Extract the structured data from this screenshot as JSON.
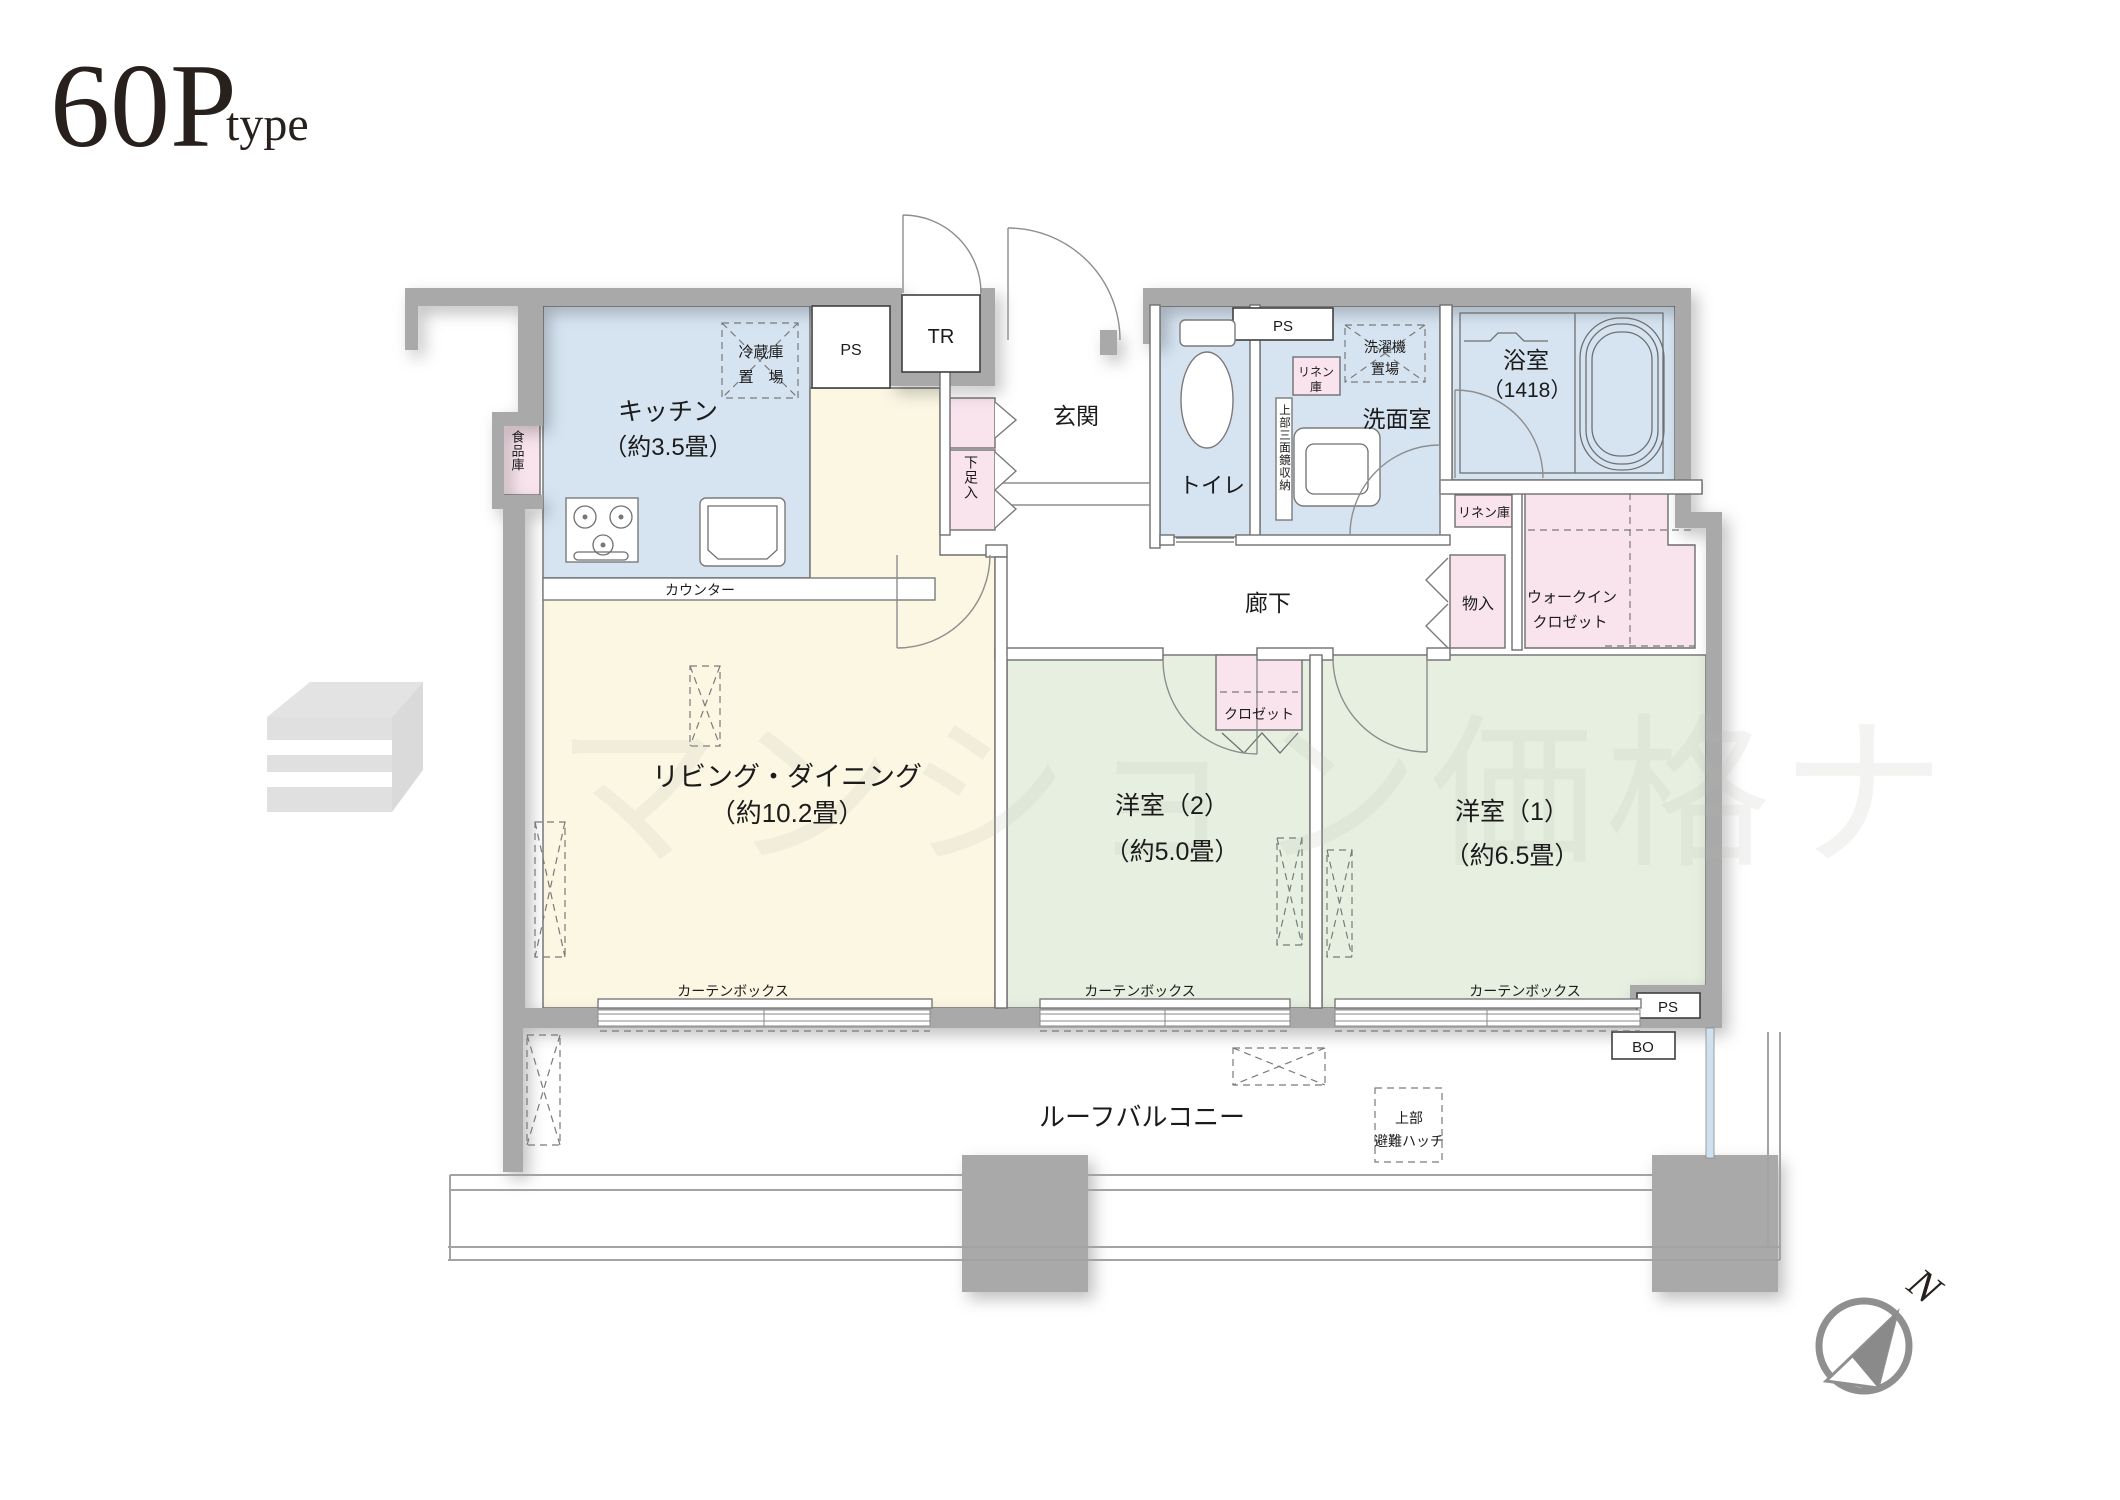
{
  "title": {
    "main": "60P",
    "sub": "type"
  },
  "watermark": {
    "text": "マンション価格ナ"
  },
  "compass": {
    "north": "N"
  },
  "colors": {
    "wall": "#a9a9a9",
    "water": "#d6e4f2",
    "living": "#fbf7e3",
    "bedroom": "#e7efe1",
    "storage_pink": "#f9e4ed",
    "glass": "#cfe0ef"
  },
  "rooms": {
    "kitchen": {
      "name": "キッチン",
      "size": "（約3.5畳）"
    },
    "living": {
      "name": "リビング・ダイニング",
      "size": "（約10.2畳）"
    },
    "bedroom2": {
      "name": "洋室（2）",
      "size": "（約5.0畳）"
    },
    "bedroom1": {
      "name": "洋室（1）",
      "size": "（約6.5畳）"
    },
    "bath": {
      "name": "浴室",
      "size": "（1418）"
    },
    "washroom": {
      "name": "洗面室"
    },
    "toilet": {
      "name": "トイレ"
    },
    "entrance": {
      "name": "玄関"
    },
    "hallway": {
      "name": "廊下"
    },
    "roof_balcony": {
      "name": "ルーフバルコニー"
    }
  },
  "storage": {
    "refrigerator": {
      "line1": "冷蔵庫",
      "line2": "置　場"
    },
    "pantry": "食品庫",
    "shoe_box": "下足入",
    "washer": {
      "line1": "洗濯機",
      "line2": "置場"
    },
    "linen_washroom": {
      "line1": "リネン",
      "line2": "庫"
    },
    "linen_hall": "リネン庫",
    "mirror_cabinet": "上部三面鏡収納",
    "closet_hall": "物入",
    "walk_in_closet": {
      "line1": "ウォークイン",
      "line2": "クロゼット"
    },
    "closet_bedroom2": "クロゼット",
    "hatch": {
      "line1": "上部",
      "line2": "避難ハッチ"
    }
  },
  "features": {
    "counter": "カウンター",
    "curtain_box": "カーテンボックス"
  },
  "shafts": {
    "ps": "PS",
    "tr": "TR",
    "bo": "BO"
  }
}
